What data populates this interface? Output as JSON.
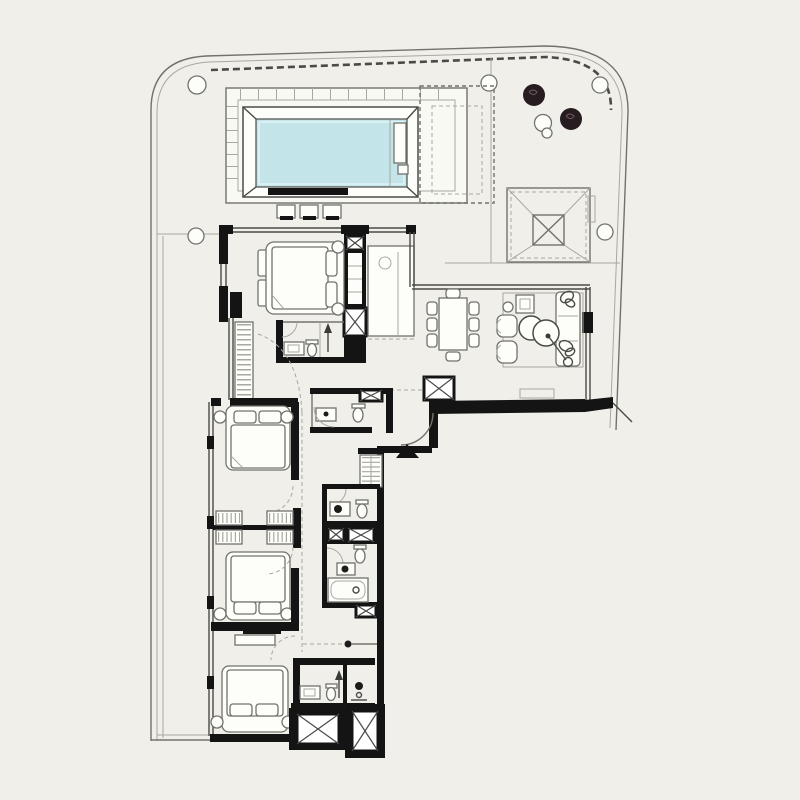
{
  "meta": {
    "title": "apartment-floor-plan",
    "kind": "architectural plan, no visible text"
  },
  "colors": {
    "background": "#f0efe9",
    "deck": "#f9f9f4",
    "pool_water": "#c3e5e9",
    "wall": "#141414",
    "line_dark": "#4a4a46",
    "line": "#72726d",
    "line_light": "#a9a8a0",
    "furniture_fill": "#fdfdfa",
    "tree_fill": "#271c20",
    "tree_vein": "#6e585e"
  },
  "legend": {
    "areas": [
      "pool terrace",
      "swimming pool",
      "pergola (dashed)",
      "roof skylight",
      "master bedroom",
      "master bathroom",
      "kitchen",
      "dining area",
      "living area",
      "entry",
      "powder room",
      "corridor",
      "bedroom 2",
      "bedroom 3",
      "bedroom 4",
      "bathroom 2",
      "bathroom 3",
      "bathroom 4",
      "service shafts",
      "west terrace",
      "east balcony"
    ],
    "objects": [
      "structural column",
      "tree planter",
      "pool stool",
      "double bed",
      "pillow",
      "bedside lamp",
      "wardrobe",
      "shelf unit",
      "dining table",
      "dining chair",
      "sofa",
      "armchair",
      "coffee table",
      "side table",
      "plant",
      "floor lamp",
      "kitchen island",
      "washbasin",
      "toilet",
      "bathtub",
      "shower arrow",
      "entry door swing",
      "entry marker triangle",
      "vent window",
      "service shaft"
    ]
  },
  "counts": {
    "bedrooms": 4,
    "bathrooms_full": 3,
    "powder_rooms": 1,
    "structural_columns": 5,
    "pool_stools": 3,
    "dining_chairs": 8,
    "service_shafts": 6
  }
}
